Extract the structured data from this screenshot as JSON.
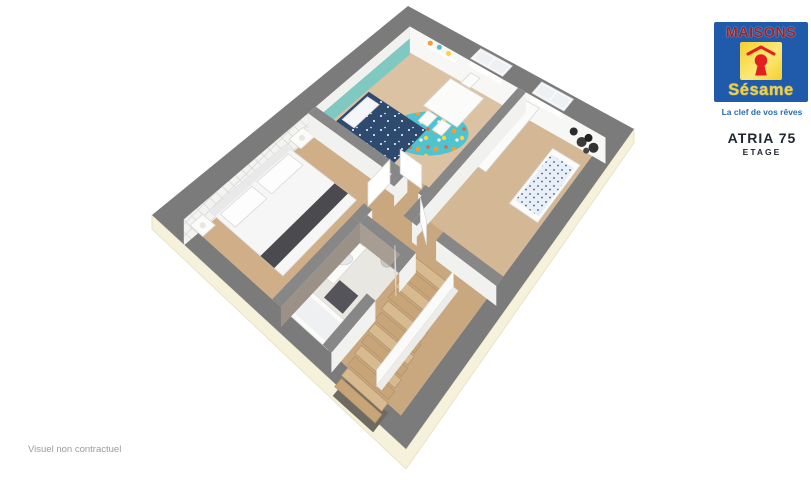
{
  "branding": {
    "name_top": "MAISONS",
    "name_bottom": "Sésame",
    "tagline": "La clef de vos rêves",
    "model": "ATRIA 75",
    "floor_label": "ETAGE"
  },
  "footnote": "Visuel non contractuel",
  "scene": {
    "type": "3d-cutaway-floorplan",
    "rooms": [
      "children-bedroom",
      "nursery",
      "master-bedroom",
      "bathroom",
      "landing-hallway",
      "staircase"
    ]
  },
  "colors": {
    "wall_gray": "#7b7b7b",
    "int_wall": "#878787",
    "facade": "#f6f1da",
    "facade_edge": "#e9e3c8",
    "wood": "#cfae88",
    "wood_mid": "#c9a77f",
    "wood_light": "#dbc2a3",
    "wood_light2": "#d4b795",
    "bath_floor": "#e9e7e2",
    "wall_face": "#f1f1ef",
    "face_bright": "#f7f7f5",
    "taupe": "#9c9187",
    "taupe_light": "#a89d92",
    "teal": "#7fc9c2",
    "teal_deep": "#56b3a9",
    "rug": "#4fc3cf",
    "navy": "#2e4a6e",
    "runner": "#4b4b4f",
    "furn_white": "#fbfbfa",
    "furn_stroke": "#d9d9d6",
    "stair_a": "#d8ba90",
    "stair_b": "#c7a578",
    "stair_edge": "#b5946a",
    "stair_shadow": "#6f6a61",
    "mat": "#54545a",
    "basket": "#c9c9c5",
    "pane": "#eef1f3",
    "tuft_base": "#f3f3f1",
    "tuft_line": "#dedad6",
    "star_white": "#ffffff",
    "dot_orange": "#f59e2c",
    "dot_yellow": "#ffd23e",
    "dot_red": "#e8633c",
    "dot_white": "#ffffff",
    "crib_base": "#e9eff6",
    "crib_dot": "#39598c",
    "logo_blue": "#1f5baa",
    "logo_red": "#9b2328",
    "logo_yellow": "#f6cf2b",
    "keyhole_red": "#e3201f",
    "tagline_blue": "#2a6db5",
    "text_dark": "#222831",
    "footnote_gray": "#9b9b9b"
  }
}
